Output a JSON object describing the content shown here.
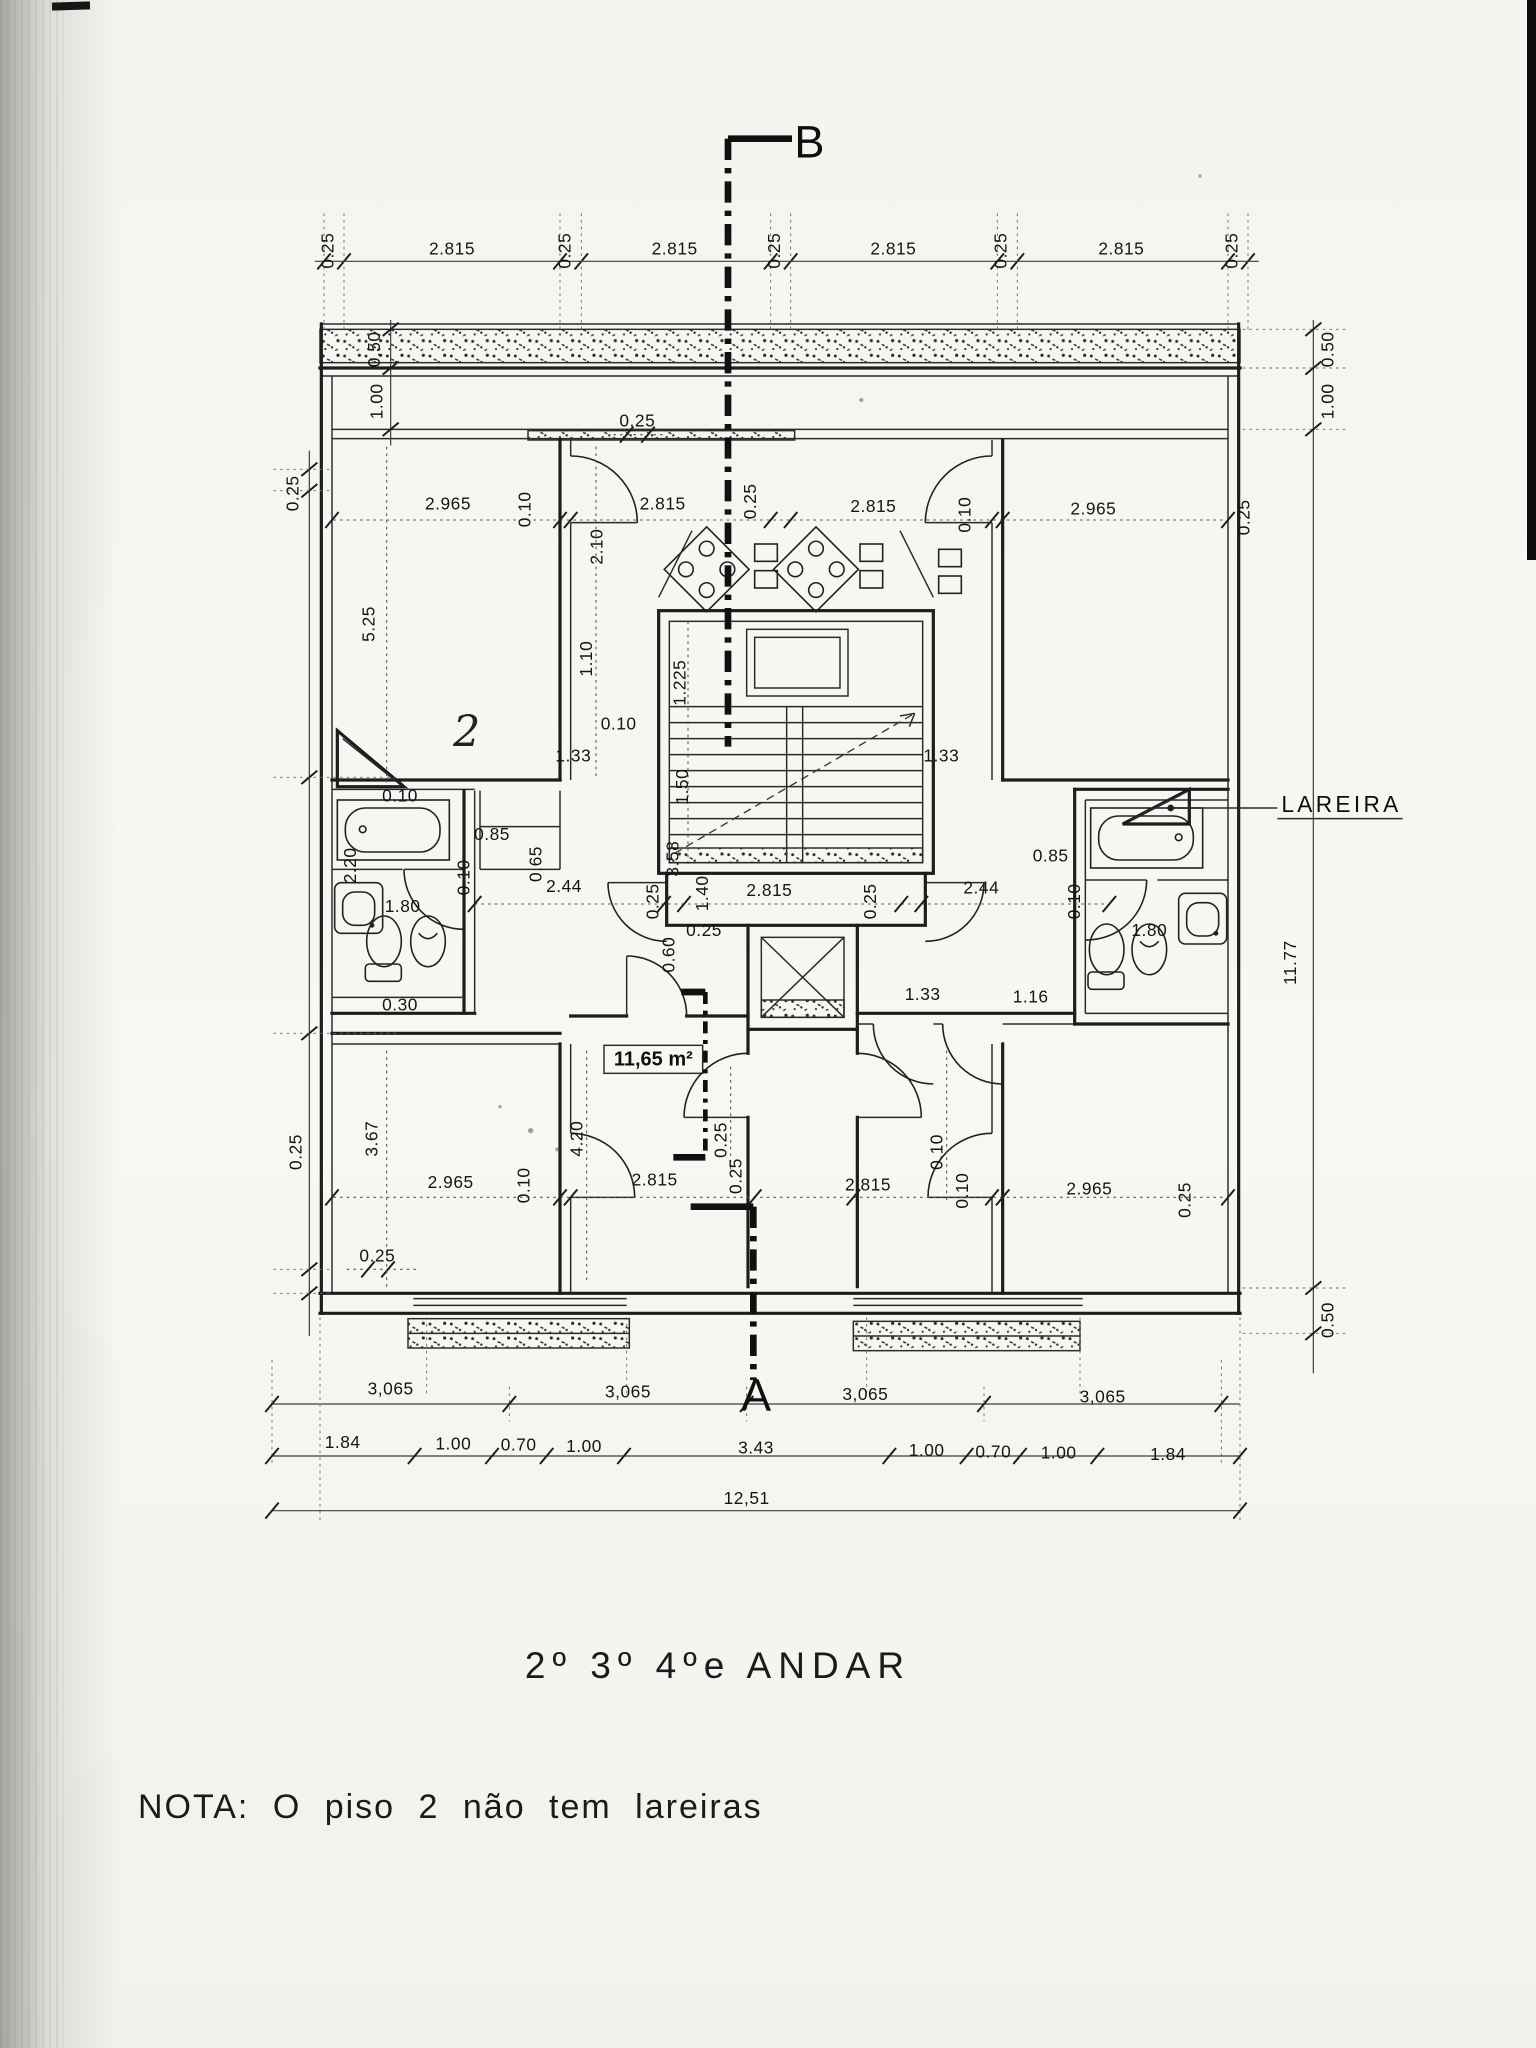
{
  "document": {
    "title": "2º 3º 4ºe ANDAR",
    "note": "NOTA: O piso 2 não tem lareiras"
  },
  "plan_labels": [
    {
      "t": "B",
      "x": 607,
      "y": 118,
      "cls": "marker"
    },
    {
      "t": "A",
      "x": 567,
      "y": 1058,
      "cls": "marker"
    },
    {
      "t": "LAREIRA",
      "x": 961,
      "y": 609,
      "cls": "lareira"
    },
    {
      "t": "11,65 m²",
      "x": 490,
      "y": 799,
      "cls": "area"
    },
    {
      "t": "2",
      "x": 350,
      "y": 560,
      "cls": "hand"
    }
  ],
  "dimensions": [
    {
      "t": "0.25",
      "x": 250,
      "y": 188,
      "r": -90
    },
    {
      "t": "2.815",
      "x": 339,
      "y": 191
    },
    {
      "t": "0.25",
      "x": 428,
      "y": 188,
      "r": -90
    },
    {
      "t": "2.815",
      "x": 506,
      "y": 191
    },
    {
      "t": "0.25",
      "x": 585,
      "y": 188,
      "r": -90
    },
    {
      "t": "2.815",
      "x": 670,
      "y": 191
    },
    {
      "t": "0.25",
      "x": 755,
      "y": 188,
      "r": -90
    },
    {
      "t": "2.815",
      "x": 841,
      "y": 191
    },
    {
      "t": "0.25",
      "x": 928,
      "y": 188,
      "r": -90
    },
    {
      "t": "0.50",
      "x": 285,
      "y": 262,
      "r": -90
    },
    {
      "t": "1.00",
      "x": 287,
      "y": 301,
      "r": -90
    },
    {
      "t": "0.50",
      "x": 1000,
      "y": 262,
      "r": -90
    },
    {
      "t": "1.00",
      "x": 1000,
      "y": 301,
      "r": -90
    },
    {
      "t": "0.25",
      "x": 224,
      "y": 370,
      "r": -90
    },
    {
      "t": "2.965",
      "x": 336,
      "y": 382
    },
    {
      "t": "0.10",
      "x": 398,
      "y": 382,
      "r": -90
    },
    {
      "t": "2.815",
      "x": 497,
      "y": 382
    },
    {
      "t": "0.25",
      "x": 567,
      "y": 376,
      "r": -90
    },
    {
      "t": "2.815",
      "x": 655,
      "y": 384
    },
    {
      "t": "0.10",
      "x": 728,
      "y": 386,
      "r": -90
    },
    {
      "t": "2.965",
      "x": 820,
      "y": 386
    },
    {
      "t": "0.25",
      "x": 937,
      "y": 388,
      "r": -90
    },
    {
      "t": "0.25",
      "x": 478,
      "y": 320
    },
    {
      "t": "2.10",
      "x": 452,
      "y": 410,
      "r": -90
    },
    {
      "t": "5.25",
      "x": 281,
      "y": 468,
      "r": -90
    },
    {
      "t": "1.10",
      "x": 444,
      "y": 494,
      "r": -90
    },
    {
      "t": "1.225",
      "x": 514,
      "y": 512,
      "r": -90
    },
    {
      "t": "0.10",
      "x": 464,
      "y": 547
    },
    {
      "t": "1.33",
      "x": 430,
      "y": 571
    },
    {
      "t": "1.33",
      "x": 706,
      "y": 571
    },
    {
      "t": "1.50",
      "x": 516,
      "y": 590,
      "r": -90
    },
    {
      "t": "3.58",
      "x": 509,
      "y": 644,
      "r": -90
    },
    {
      "t": "0.10",
      "x": 300,
      "y": 601
    },
    {
      "t": "2.20",
      "x": 267,
      "y": 649,
      "r": -90
    },
    {
      "t": "0.85",
      "x": 369,
      "y": 630
    },
    {
      "t": "0.65",
      "x": 406,
      "y": 648,
      "r": -90
    },
    {
      "t": "0.10",
      "x": 352,
      "y": 658,
      "r": -90
    },
    {
      "t": "2.44",
      "x": 423,
      "y": 669
    },
    {
      "t": "1.80",
      "x": 302,
      "y": 684
    },
    {
      "t": "0.30",
      "x": 300,
      "y": 758
    },
    {
      "t": "0.25",
      "x": 494,
      "y": 676,
      "r": -90
    },
    {
      "t": "1.40",
      "x": 531,
      "y": 670,
      "r": -90
    },
    {
      "t": "2.815",
      "x": 577,
      "y": 672
    },
    {
      "t": "0.25",
      "x": 657,
      "y": 676,
      "r": -90
    },
    {
      "t": "2.44",
      "x": 736,
      "y": 670
    },
    {
      "t": "0.85",
      "x": 788,
      "y": 646
    },
    {
      "t": "0.10",
      "x": 810,
      "y": 676,
      "r": -90
    },
    {
      "t": "1.80",
      "x": 862,
      "y": 702
    },
    {
      "t": "0.60",
      "x": 506,
      "y": 716,
      "r": -90
    },
    {
      "t": "0.25",
      "x": 528,
      "y": 702
    },
    {
      "t": "1.33",
      "x": 692,
      "y": 750
    },
    {
      "t": "1.16",
      "x": 773,
      "y": 752
    },
    {
      "t": "11.77",
      "x": 972,
      "y": 722,
      "r": -90
    },
    {
      "t": "0.25",
      "x": 545,
      "y": 855,
      "r": -90
    },
    {
      "t": "4.20",
      "x": 437,
      "y": 854,
      "r": -90
    },
    {
      "t": "3.67",
      "x": 283,
      "y": 854,
      "r": -90
    },
    {
      "t": "0.10",
      "x": 707,
      "y": 864,
      "r": -90
    },
    {
      "t": "0.25",
      "x": 226,
      "y": 864,
      "r": -90
    },
    {
      "t": "2.965",
      "x": 338,
      "y": 891
    },
    {
      "t": "0.10",
      "x": 397,
      "y": 889,
      "r": -90
    },
    {
      "t": "2.815",
      "x": 491,
      "y": 889
    },
    {
      "t": "0.25",
      "x": 556,
      "y": 882,
      "r": -90
    },
    {
      "t": "2.815",
      "x": 651,
      "y": 893
    },
    {
      "t": "0.10",
      "x": 726,
      "y": 893,
      "r": -90
    },
    {
      "t": "2.965",
      "x": 817,
      "y": 896
    },
    {
      "t": "0.25",
      "x": 893,
      "y": 900,
      "r": -90
    },
    {
      "t": "0.25",
      "x": 283,
      "y": 946
    },
    {
      "t": "0.50",
      "x": 1000,
      "y": 990,
      "r": -90
    },
    {
      "t": "3,065",
      "x": 293,
      "y": 1046
    },
    {
      "t": "3,065",
      "x": 471,
      "y": 1048
    },
    {
      "t": "3,065",
      "x": 649,
      "y": 1050
    },
    {
      "t": "3,065",
      "x": 827,
      "y": 1052
    },
    {
      "t": "1.84",
      "x": 257,
      "y": 1086
    },
    {
      "t": "1.00",
      "x": 340,
      "y": 1087
    },
    {
      "t": "0.70",
      "x": 389,
      "y": 1088
    },
    {
      "t": "1.00",
      "x": 438,
      "y": 1089
    },
    {
      "t": "3.43",
      "x": 567,
      "y": 1090
    },
    {
      "t": "1.00",
      "x": 695,
      "y": 1092
    },
    {
      "t": "0.70",
      "x": 745,
      "y": 1093
    },
    {
      "t": "1.00",
      "x": 794,
      "y": 1094
    },
    {
      "t": "1.84",
      "x": 876,
      "y": 1095
    },
    {
      "t": "12,51",
      "x": 560,
      "y": 1128
    }
  ],
  "colors": {
    "ink": "#1d1d1d",
    "paper": "#f7f6f2",
    "scan_shadow": "#6e6c66",
    "edge_strip": "#0c0c0c"
  }
}
